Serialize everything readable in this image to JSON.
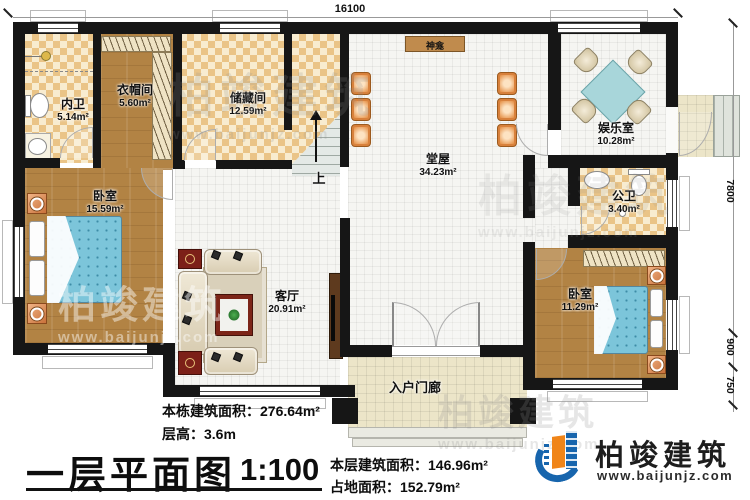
{
  "plan": {
    "rooms": [
      {
        "id": "inner-bath",
        "name": "内卫",
        "area": "5.14m²"
      },
      {
        "id": "cloakroom",
        "name": "衣帽间",
        "area": "5.60m²"
      },
      {
        "id": "storage",
        "name": "储藏间",
        "area": "12.59m²"
      },
      {
        "id": "main-hall",
        "name": "堂屋",
        "area": "34.23m²"
      },
      {
        "id": "entertainment",
        "name": "娱乐室",
        "area": "10.28m²"
      },
      {
        "id": "public-bath",
        "name": "公卫",
        "area": "3.40m²"
      },
      {
        "id": "bedroom-left",
        "name": "卧室",
        "area": "15.59m²"
      },
      {
        "id": "living-room",
        "name": "客厅",
        "area": "20.91m²"
      },
      {
        "id": "bedroom-right",
        "name": "卧室",
        "area": "11.29m²"
      },
      {
        "id": "entry-porch",
        "name": "入户门廊",
        "area": ""
      }
    ],
    "shrine_label": "神龛",
    "stairs_up_label": "上"
  },
  "dimensions": {
    "top_width": "16100",
    "right_height": "7800",
    "right_porch_depth": "900",
    "right_steps_depth": "750"
  },
  "annotations": {
    "building_total_area": "本栋建筑面积：276.64m²",
    "floor_height": "层高：3.6m",
    "plan_title": "一层平面图",
    "scale": "1:100",
    "floor_area": "本层建筑面积：146.96m²",
    "footprint_area": "占地面积：152.79m²"
  },
  "branding": {
    "company": "柏竣建筑",
    "website": "www.baijunjz.com"
  },
  "watermark": {
    "text": "柏竣建筑",
    "website": "www.baijunjz.com"
  }
}
